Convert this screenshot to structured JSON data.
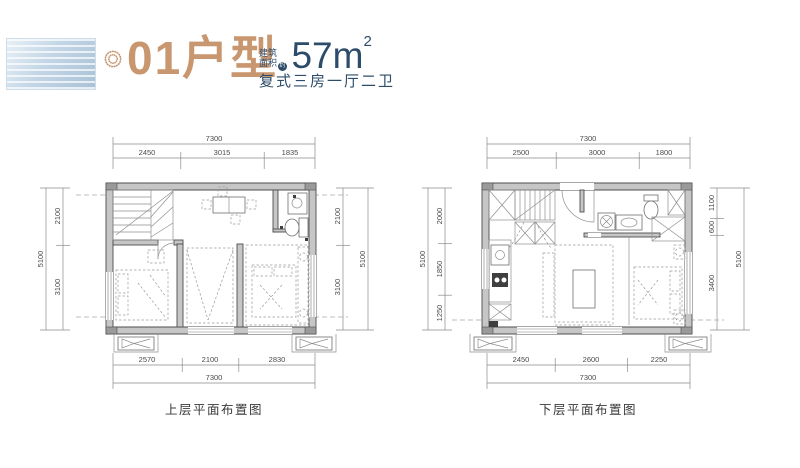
{
  "colors": {
    "accent_tan": "#c9976f",
    "navy": "#2d4c6a",
    "logo_blue": "#a9c2d8",
    "plan_line": "#4d4d4d"
  },
  "header": {
    "unit_label": "01户型",
    "area_note_line1": "建筑",
    "area_note_line2": "面积",
    "area_note_badge": "约",
    "area_value": "57m",
    "area_sup": "2",
    "subtitle": "复式三房一厅二卫"
  },
  "plans": {
    "upper": {
      "caption": "上层平面布置图",
      "top_overall": "7300",
      "top_segs": [
        "2450",
        "3015",
        "1835"
      ],
      "bottom_segs": [
        "2570",
        "2100",
        "2830"
      ],
      "bottom_overall": "7300",
      "left_overall": "5100",
      "left_segs": [
        "2100",
        "3100"
      ],
      "right_segs": [
        "2100",
        "3100"
      ],
      "right_overall": "5100"
    },
    "lower": {
      "caption": "下层平面布置图",
      "top_overall": "7300",
      "top_segs": [
        "2500",
        "3000",
        "1800"
      ],
      "bottom_segs": [
        "2450",
        "2600",
        "2250"
      ],
      "bottom_overall": "7300",
      "left_overall": "5100",
      "left_segs": [
        "2000",
        "1850",
        "1250"
      ],
      "right_segs": [
        "1100",
        "600",
        "3400"
      ],
      "right_overall": "5100"
    }
  }
}
